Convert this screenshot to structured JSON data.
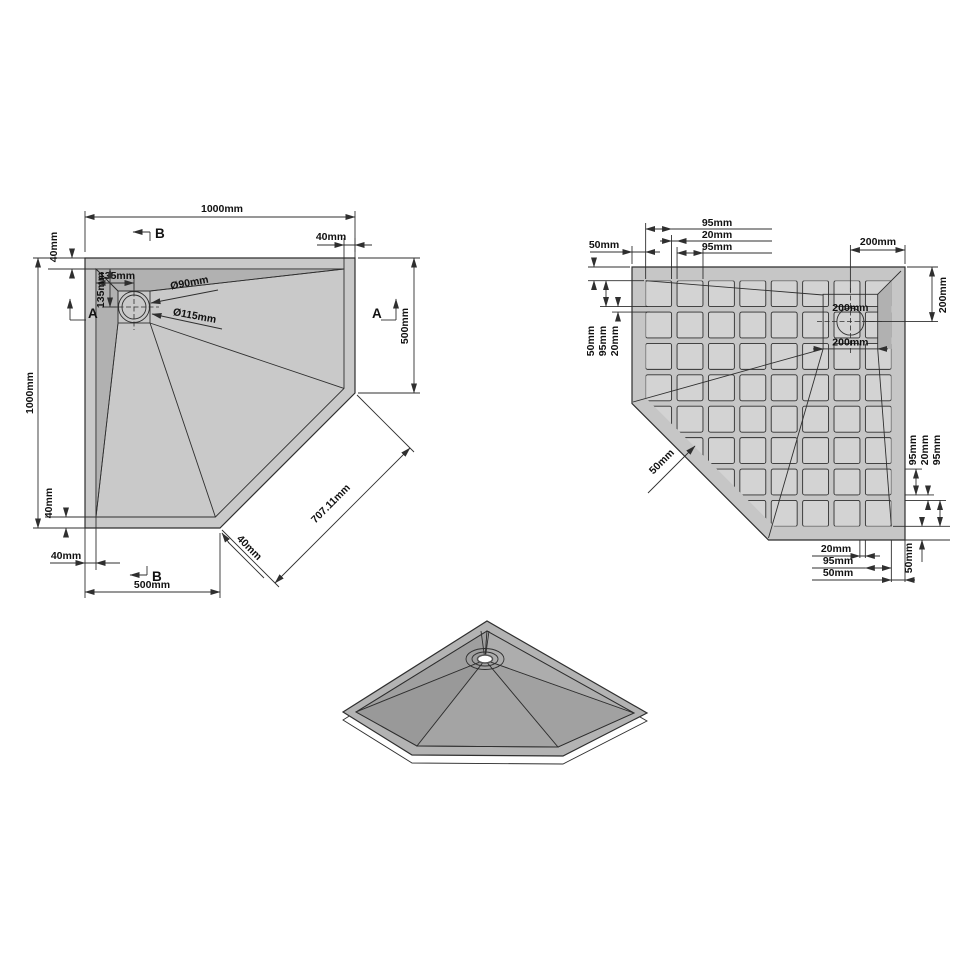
{
  "drawing_title": "Pentagonal shower tray technical drawing",
  "colors": {
    "line": "#2f2f2f",
    "plan_rim": "#c9c9c9",
    "plan_floor": "#d8d8d8",
    "plan_slope": "#b1b1b1",
    "bv_base": "#c6c6c6",
    "bv_cell": "#d3d3d3",
    "bv_dark": "#b1b1b1",
    "iso_side": "#8b8b8b",
    "iso_rim": "#b3b3b3",
    "iso_floor": "#a4a4a4",
    "drain_white": "#ffffff"
  },
  "plan_view": {
    "labels": {
      "width_top": "1000mm",
      "height_left": "1000mm",
      "rim_top_left": "40mm",
      "rim_top_right": "40mm",
      "rim_bottom_left_v": "40mm",
      "rim_bottom_left_h": "40mm",
      "rim_diagonal": "40mm",
      "drain_offset_x": "135mm",
      "drain_offset_y": "135mm",
      "drain_inner_dia": "Ø90mm",
      "drain_outer_dia": "Ø115mm",
      "right_side": "500mm",
      "bottom_side": "500mm",
      "diagonal_side": "707.11mm",
      "section_a": "A",
      "section_b": "B"
    }
  },
  "bottom_view": {
    "labels": {
      "top_margin": "50mm",
      "top_sq1": "95mm",
      "top_gap": "20mm",
      "top_sq2": "95mm",
      "top_drain_offset": "200mm",
      "right_drain_offset": "200mm",
      "drain_width": "200mm",
      "drain_height": "200mm",
      "left_margin": "50mm",
      "left_sq": "95mm",
      "left_gap": "20mm",
      "right_sq1": "95mm",
      "right_gap": "20mm",
      "right_sq2": "95mm",
      "right_bottom_margin": "50mm",
      "bottom_gap": "20mm",
      "bottom_sq": "95mm",
      "bottom_margin": "50mm",
      "diagonal_margin": "50mm"
    },
    "grid": {
      "cols": 8,
      "rows": 8
    }
  }
}
